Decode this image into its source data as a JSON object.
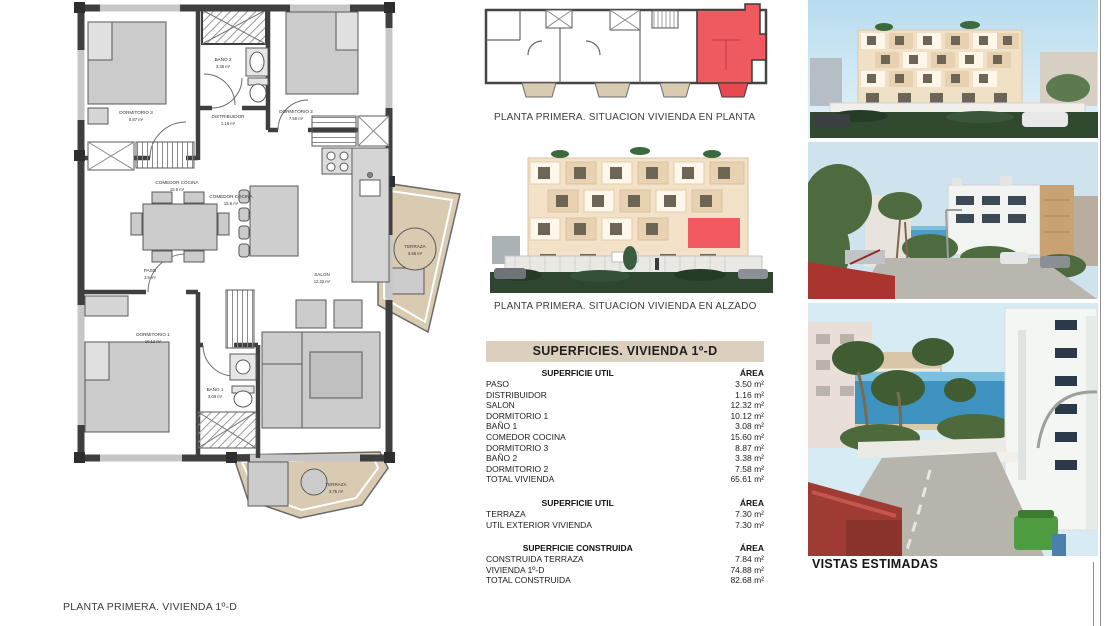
{
  "colors": {
    "highlight_red": "#ee5a60",
    "terrace_tan": "#d9cbb1",
    "table_header_bg": "#dccfbd",
    "wall_dark": "#3f3f3f"
  },
  "floor_plan": {
    "rooms": [
      {
        "name": "DORMITORIO 3",
        "area": "8.87 m²"
      },
      {
        "name": "BAÑO 2",
        "area": "3.38 m²"
      },
      {
        "name": "DORMITORIO 2",
        "area": "7.58 m²"
      },
      {
        "name": "DISTRIBUIDOR",
        "area": "1.16 m²"
      },
      {
        "name": "COMEDOR COCINA",
        "area": "15.6 m²"
      },
      {
        "name": "PASO",
        "area": "3.5 m²"
      },
      {
        "name": "SALON",
        "area": "12.32 m²"
      },
      {
        "name": "DORMITORIO 1",
        "area": "10.12 m²"
      },
      {
        "name": "BAÑO 1",
        "area": "3.08 m²"
      },
      {
        "name": "TERRAZA",
        "area": "3.75 m²"
      },
      {
        "name": "TERRAZA",
        "area": "3.55 m²"
      }
    ]
  },
  "situation": {
    "plan_caption": "PLANTA PRIMERA. SITUACION VIVIENDA EN PLANTA",
    "elevation_caption": "PLANTA PRIMERA. SITUACION VIVIENDA EN ALZADO"
  },
  "surfaces_table": {
    "title": "SUPERFICIES. VIVIENDA 1º-D",
    "area_header": "ÁREA",
    "sections": [
      {
        "heading": "SUPERFICIE UTIL",
        "rows": [
          [
            "PASO",
            "3.50 m²"
          ],
          [
            "DISTRIBUIDOR",
            "1.16 m²"
          ],
          [
            "SALON",
            "12.32 m²"
          ],
          [
            "DORMITORIO 1",
            "10.12 m²"
          ],
          [
            "BAÑO 1",
            "3.08 m²"
          ],
          [
            "COMEDOR COCINA",
            "15.60 m²"
          ],
          [
            "DORMITORIO 3",
            "8.87 m²"
          ],
          [
            "BAÑO 2",
            "3.38 m²"
          ],
          [
            "DORMITORIO 2",
            "7.58 m²"
          ],
          [
            "TOTAL VIVIENDA",
            "65.61 m²"
          ]
        ]
      },
      {
        "heading": "SUPERFICIE UTIL",
        "rows": [
          [
            "TERRAZA",
            "7.30 m²"
          ],
          [
            "UTIL EXTERIOR VIVIENDA",
            "7.30 m²"
          ]
        ]
      },
      {
        "heading": "SUPERFICIE CONSTRUIDA",
        "rows": [
          [
            "CONSTRUIDA TERRAZA",
            "7.84 m²"
          ],
          [
            "VIVIENDA 1º-D",
            "74.88 m²"
          ],
          [
            "TOTAL CONSTRUIDA",
            "82.68 m²"
          ]
        ]
      }
    ]
  },
  "views": {
    "caption": "VISTAS ESTIMADAS"
  },
  "footer": {
    "left": "PLANTA PRIMERA. VIVIENDA 1º-D"
  }
}
